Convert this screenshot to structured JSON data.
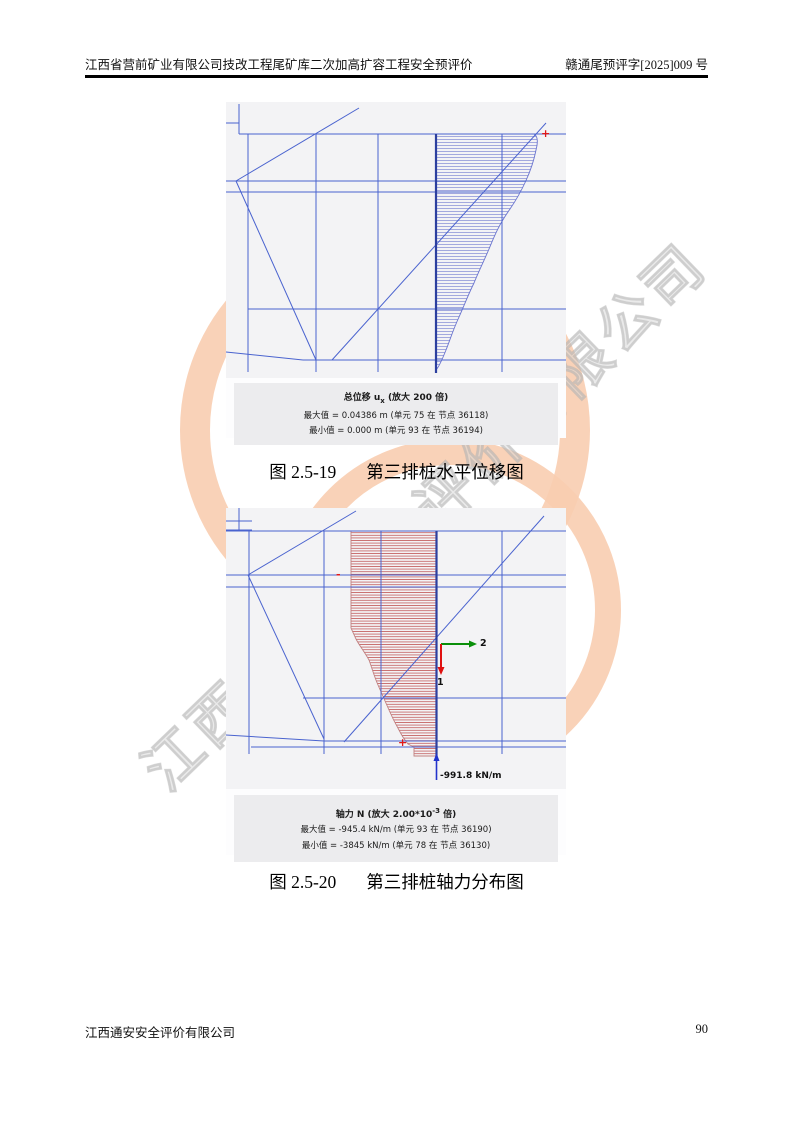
{
  "page": {
    "header": {
      "left": "江西省营前矿业有限公司技改工程尾矿库二次加高扩容工程安全预评价",
      "right": "赣通尾预评字[2025]009 号"
    },
    "footer": {
      "company": "江西通安安全评价有限公司",
      "page_number": "90"
    },
    "watermark": {
      "text": "江西通安安全评价有限公司",
      "arc_color": "#f8cdb0"
    }
  },
  "colors": {
    "mesh_blue": "#4a63cf",
    "pile_blue": "#2c3f9f",
    "hatch_blue": "#9aa0dc",
    "hatch_red": "#c25b5b",
    "marker_red": "#e01818",
    "axis_green": "#0a8f0a",
    "axis_red": "#e01010",
    "arrow_blue": "#2233cc"
  },
  "figure1": {
    "caption": {
      "number": "图 2.5-19",
      "title": "第三排桩水平位移图"
    },
    "legend": {
      "title_prefix": "总位移 u",
      "title_sub": "x",
      "title_suffix": " (放大 200 倍)",
      "max_line": "最大值 = 0.04386 m (单元 75 在 节点 36118)",
      "min_line": "最小值 = 0.000 m (单元 93 在 节点 36194)"
    },
    "markers": {
      "plus": "+"
    }
  },
  "figure2": {
    "caption": {
      "number": "图 2.5-20",
      "title": "第三排桩轴力分布图"
    },
    "legend": {
      "title_prefix": "轴力 N (放大 2.00*10",
      "title_sup": "-3",
      "title_suffix": " 倍)",
      "max_line": "最大值 = -945.4 kN/m (单元 93 在 节点 36190)",
      "min_line": "最小值 = -3845 kN/m (单元 78 在 节点 36130)"
    },
    "axis": {
      "label_1": "1",
      "label_2": "2"
    },
    "force_label": "-991.8 kN/m",
    "markers": {
      "plus": "+",
      "minus": "-"
    }
  }
}
